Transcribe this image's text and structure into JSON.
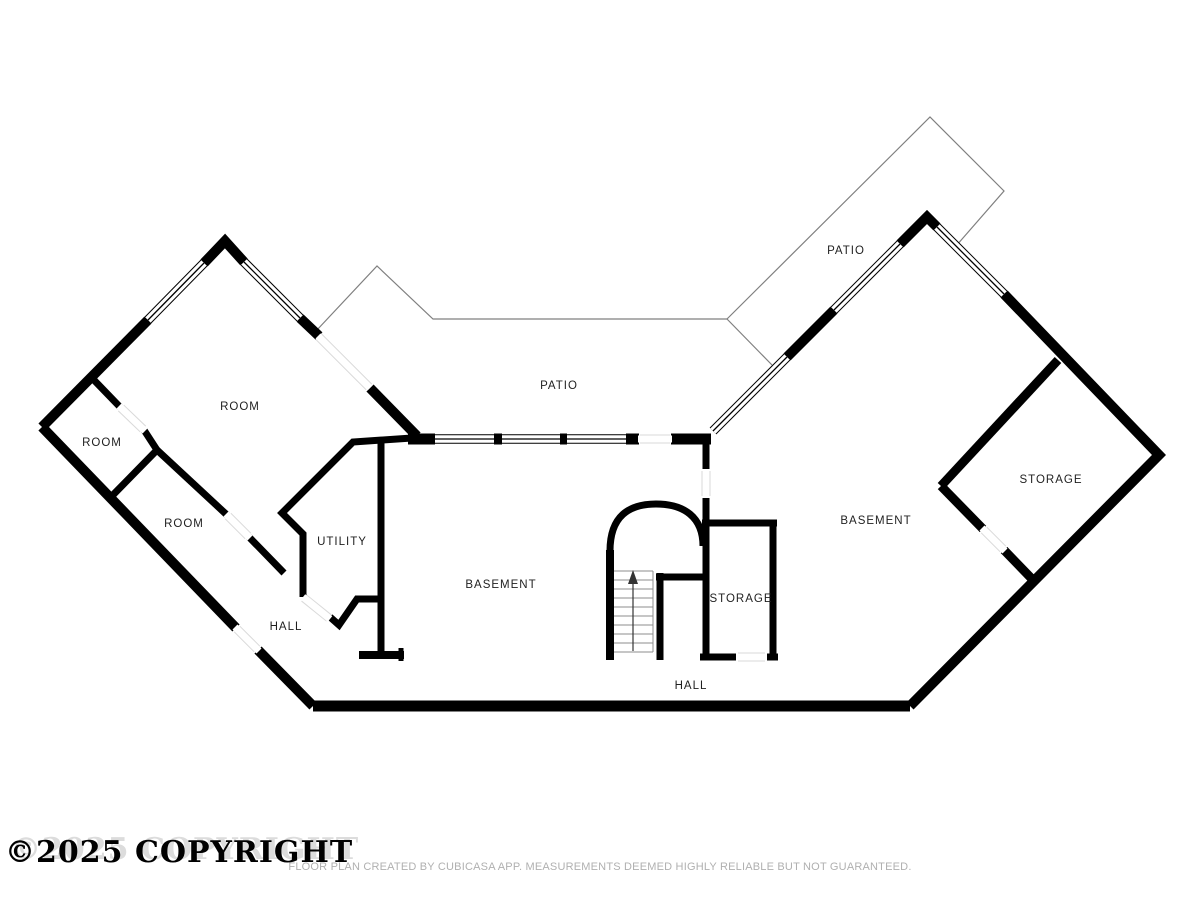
{
  "labels": {
    "room_main": "ROOM",
    "room_west": "ROOM",
    "room_south": "ROOM",
    "patio_center": "PATIO",
    "patio_northeast": "PATIO",
    "utility": "UTILITY",
    "basement_center": "BASEMENT",
    "basement_east": "BASEMENT",
    "storage_center": "STORAGE",
    "storage_east": "STORAGE",
    "hall_west": "HALL",
    "hall_center": "HALL"
  },
  "watermark": {
    "text": "©2025 COPYRIGHT"
  },
  "footer": {
    "disclaimer": "FLOOR PLAN CREATED BY CUBICASA APP. MEASUREMENTS DEEMED HIGHLY RELIABLE BUT NOT GUARANTEED."
  },
  "colors": {
    "wall": "#000000",
    "patio_outline": "#7f7f7f",
    "door_edge": "#d9d9d9",
    "stair_tread": "#8c8c8c",
    "label_text": "#1f1f1f",
    "footer_text": "#b0b0b0"
  }
}
